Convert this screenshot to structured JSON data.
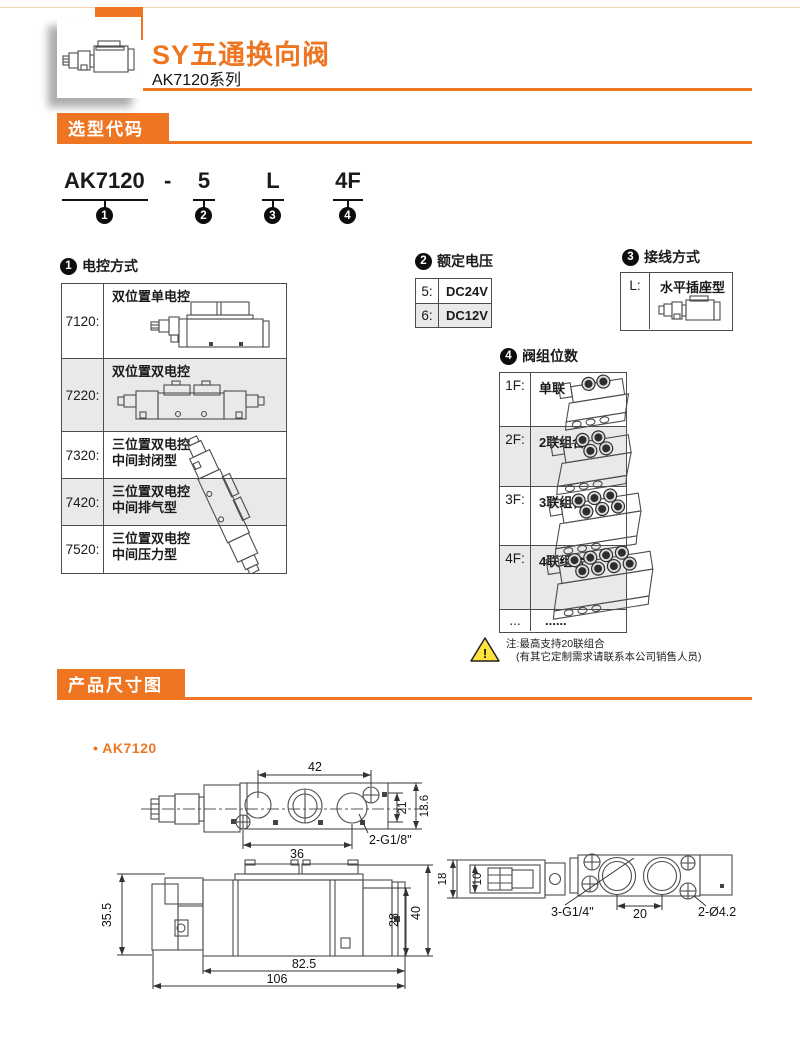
{
  "colors": {
    "accent": "#EE7623",
    "row_alt": "#E9E9E9",
    "warning_yellow": "#FFE23E"
  },
  "header": {
    "title": "SY五通换向阀",
    "subtitle": "AK7120系列"
  },
  "badges": {
    "selection": "选型代码",
    "dimensions": "产品尺寸图"
  },
  "model_code": {
    "base": "AK7120",
    "dash": "-",
    "voltage": "5",
    "wiring": "L",
    "stations": "4F",
    "num1": "1",
    "num2": "2",
    "num3": "3",
    "num4": "4"
  },
  "sections": {
    "control": {
      "num": "1",
      "title": "电控方式",
      "rows": [
        {
          "code": "7120:",
          "line1": "双位置单电控",
          "line2": ""
        },
        {
          "code": "7220:",
          "line1": "双位置双电控",
          "line2": ""
        },
        {
          "code": "7320:",
          "line1": "三位置双电控",
          "line2": "中间封闭型"
        },
        {
          "code": "7420:",
          "line1": "三位置双电控",
          "line2": "中间排气型"
        },
        {
          "code": "7520:",
          "line1": "三位置双电控",
          "line2": "中间压力型"
        }
      ]
    },
    "voltage": {
      "num": "2",
      "title": "额定电压",
      "rows": [
        {
          "code": "5:",
          "label": "DC24V"
        },
        {
          "code": "6:",
          "label": "DC12V"
        }
      ]
    },
    "wiring": {
      "num": "3",
      "title": "接线方式",
      "code": "L:",
      "label": "水平插座型"
    },
    "stations": {
      "num": "4",
      "title": "阀组位数",
      "rows": [
        {
          "code": "1F:",
          "label": "单联"
        },
        {
          "code": "2F:",
          "label": "2联组合"
        },
        {
          "code": "3F:",
          "label": "3联组合"
        },
        {
          "code": "4F:",
          "label": "4联组合"
        },
        {
          "code": "...",
          "label": "......"
        }
      ]
    },
    "note": {
      "line1": "注:最高支持20联组合",
      "line2": "(有其它定制需求请联系本公司销售人员)",
      "warn_glyph": "!"
    }
  },
  "dims": {
    "bullet": "•",
    "model": "AK7120",
    "top": {
      "w42": "42",
      "w36": "36",
      "port": "2-G1/8\"",
      "h21": "21",
      "h136": "13.6"
    },
    "front": {
      "h355": "35.5",
      "h28": "28",
      "h40": "40",
      "w825": "82.5",
      "w106": "106"
    },
    "bottom": {
      "h18": "18",
      "h10": "10",
      "port": "3-G1/4\"",
      "w20": "20",
      "holes": "2-Ø4.2"
    }
  }
}
